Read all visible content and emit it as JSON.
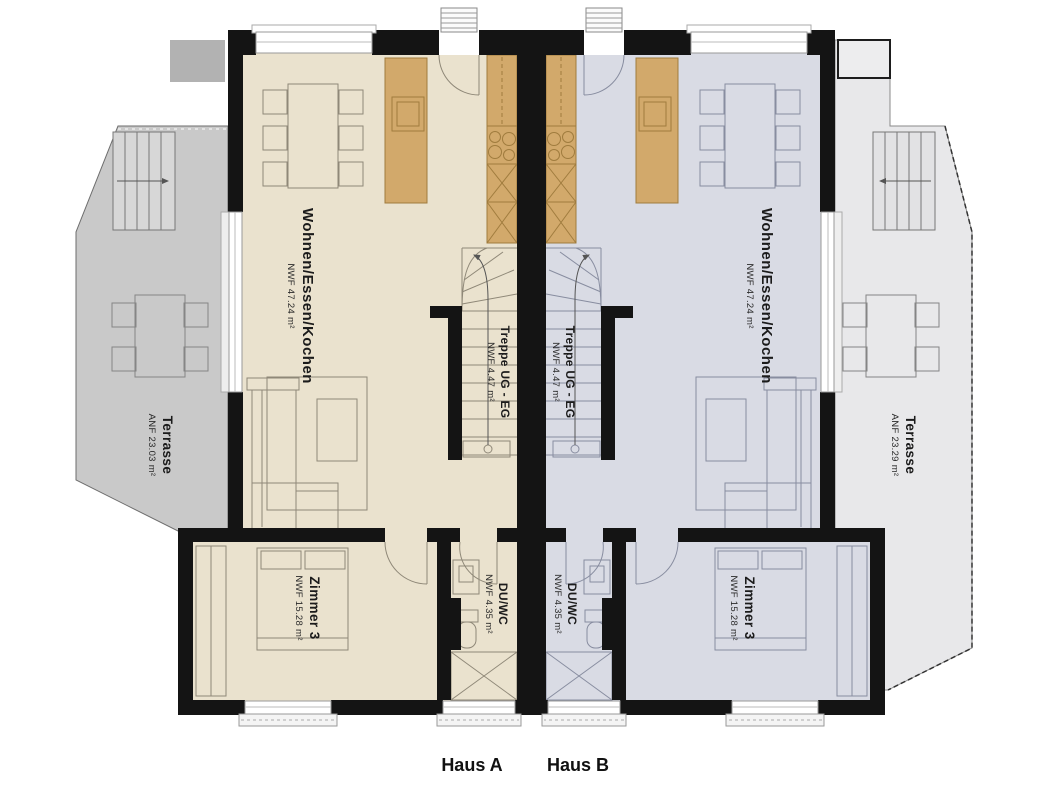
{
  "caption": {
    "haus_a": "Haus A",
    "haus_b": "Haus B"
  },
  "house_a": {
    "living": {
      "name": "Wohnen/Essen/Kochen",
      "area": "NWF 47.24 m²"
    },
    "stairs": {
      "name": "Treppe UG - EG",
      "area": "NWF 4.47 m²"
    },
    "room3": {
      "name": "Zimmer 3",
      "area": "NWF 15.28 m²"
    },
    "bath": {
      "name": "DU/WC",
      "area": "NWF 4.35 m²"
    },
    "terrace": {
      "name": "Terrasse",
      "area": "ANF 23.03 m²"
    }
  },
  "house_b": {
    "living": {
      "name": "Wohnen/Essen/Kochen",
      "area": "NWF 47.24 m²"
    },
    "stairs": {
      "name": "Treppe UG - EG",
      "area": "NWF 4.47 m²"
    },
    "room3": {
      "name": "Zimmer 3",
      "area": "NWF 15.28 m²"
    },
    "bath": {
      "name": "DU/WC",
      "area": "NWF 4.35 m²"
    },
    "terrace": {
      "name": "Terrasse",
      "area": "ANF 23.29 m²"
    }
  },
  "colors": {
    "wall": "#141414",
    "floor_house_a": "#eae2ce",
    "floor_house_b": "#d9dbe4",
    "kitchen_counter": "#d2a96b",
    "terrace_left": "#c9c9c9",
    "terrace_right": "#e8e8ea"
  }
}
